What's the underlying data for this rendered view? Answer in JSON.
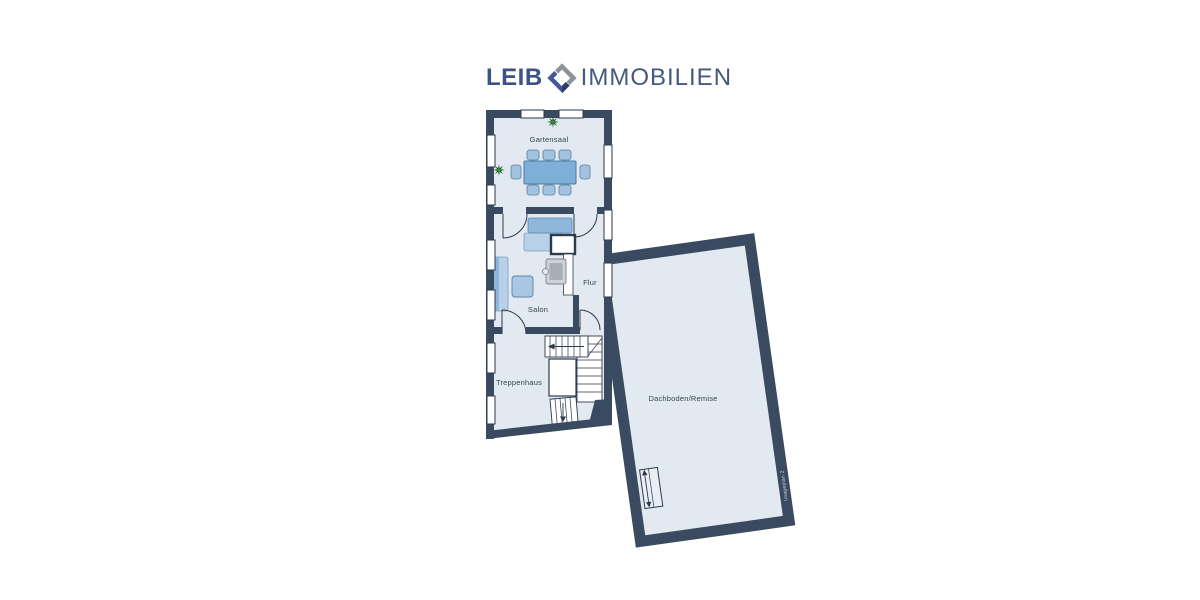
{
  "logo": {
    "text_left": "LEIB",
    "text_right": "IMMOBILIEN",
    "icon": "diamond-logo-icon",
    "colors": {
      "text_left": "#3b5386",
      "text_right": "#45587e",
      "icon_gray": "#8d939c",
      "icon_blue": "#41599a",
      "icon_blue_dark": "#2c3f66"
    }
  },
  "floorplan": {
    "rooms": [
      {
        "label": "Gartensaal"
      },
      {
        "label": "Salon"
      },
      {
        "label": "Flur"
      },
      {
        "label": "Treppenhaus"
      },
      {
        "label": "Dachboden/Remise"
      }
    ],
    "watermark": "Imageplan 2",
    "colors": {
      "wall": "#3a4a60",
      "floor": "#e3e9f0",
      "outline": "#2e3a4c",
      "window": "#ffffff",
      "label": "#39424e",
      "table_blue": "#7fafd6",
      "chair_blue": "#a3c2df",
      "sofa_back_blue": "#8fb7dc",
      "sofa_seat_blue": "#b8d0e8",
      "stove_gray": "#ced3d9",
      "plant_green": "#1b531f"
    }
  }
}
